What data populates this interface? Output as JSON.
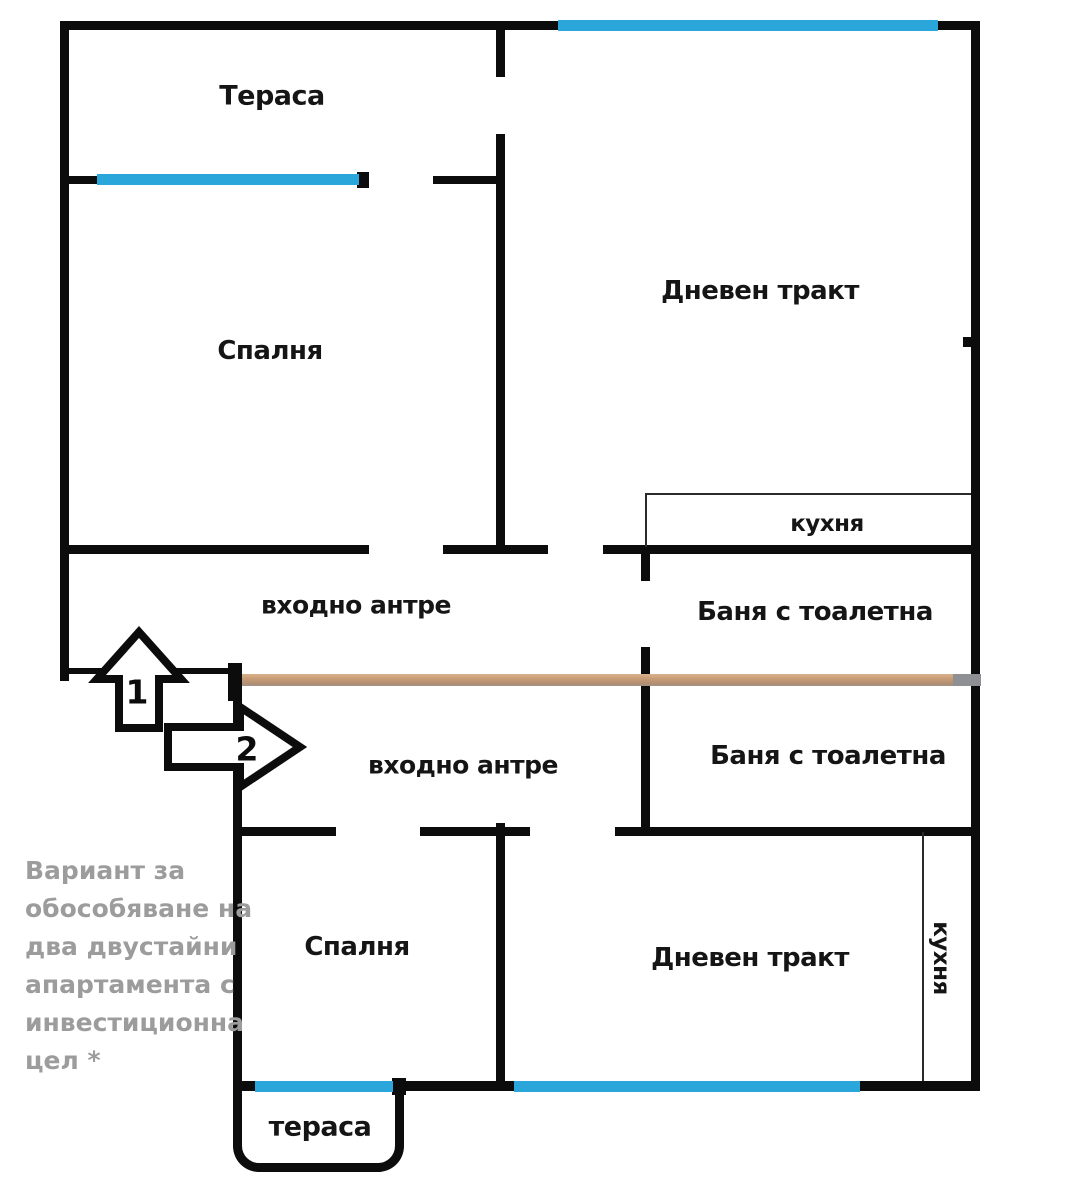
{
  "colors": {
    "wall": "#0c0c0c",
    "window": "#2ba6db",
    "divider": "#c59a74",
    "divider_cap": "#8f9094",
    "annotation_text": "#9c9c9c"
  },
  "apartment_top": {
    "terrace": "Тераса",
    "bedroom": "Спалня",
    "living": "Дневен тракт",
    "kitchen": "кухня",
    "hall": "входно антре",
    "bath": "Баня с тоалетна"
  },
  "apartment_bottom": {
    "hall": "входно антре",
    "bath": "Баня с тоалетна",
    "bedroom": "Спалня",
    "living": "Дневен тракт",
    "kitchen": "кухня",
    "terrace": "тераса"
  },
  "entrance_arrows": {
    "arrow_1": "1",
    "arrow_2": "2"
  },
  "annotation": {
    "lines": [
      "Вариант за",
      "обособяване на",
      "два двустайни",
      "апартамента с",
      "инвестиционна",
      "цел *"
    ]
  }
}
